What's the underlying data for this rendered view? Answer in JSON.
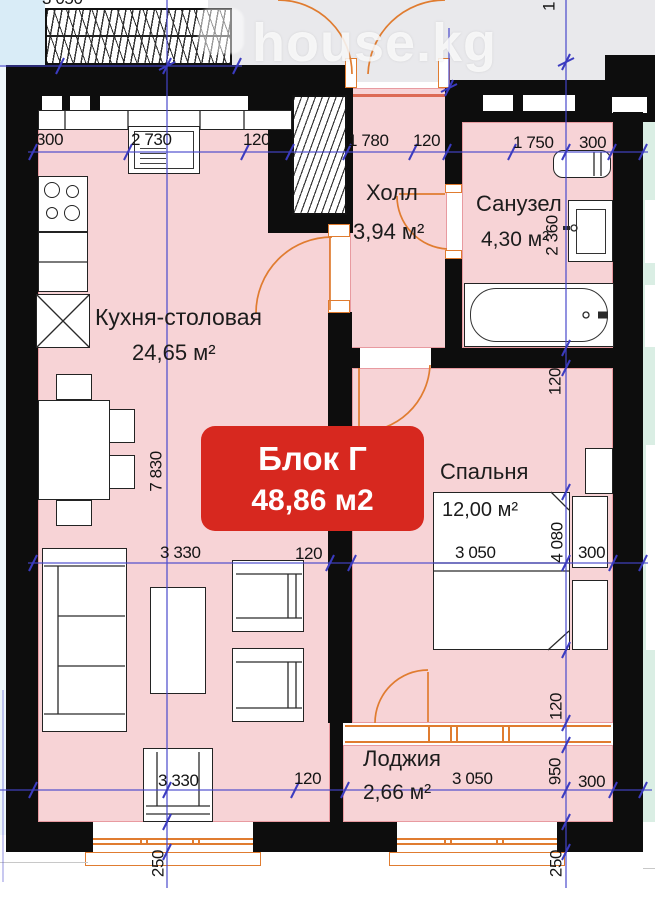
{
  "watermark": {
    "text": "house.kg"
  },
  "badge": {
    "title": "Блок Г",
    "area": "48,86 м2",
    "color": "#d7281f"
  },
  "rooms": {
    "kitchen": {
      "name": "Кухня-столовая",
      "area": "24,65 м²"
    },
    "hall": {
      "name": "Холл",
      "area": "3,94 м²"
    },
    "bathroom": {
      "name": "Санузел",
      "area": "4,30 м²"
    },
    "bedroom": {
      "name": "Спальня",
      "area": "12,00 м²"
    },
    "loggia": {
      "name": "Лоджия",
      "area": "2,66 м²"
    }
  },
  "dimensions": {
    "topleft": {
      "d3050": "3 050"
    },
    "top": {
      "d300a": "300",
      "d2730": "2 730",
      "d120a": "120",
      "d1780": "1 780",
      "d120b": "120",
      "d1750": "1 750",
      "d300b": "300"
    },
    "middle": {
      "d3330": "3 330",
      "d120": "120",
      "d3050": "3 050",
      "d300": "300"
    },
    "bottom": {
      "d3330": "3 330",
      "d120": "120",
      "d3050": "3 050",
      "d300": "300"
    },
    "left": {
      "d7830": "7 830",
      "d250": "250"
    },
    "right": {
      "d1": "1",
      "d2360": "2 360",
      "d120a": "120",
      "d4080": "4 080",
      "d120b": "120",
      "d950": "950",
      "d250": "250"
    }
  },
  "colors": {
    "room_pink": "#f7d3d6",
    "wall_black": "#0d0d0d",
    "door_orange": "#e07c30",
    "dim_blue": "#4545cb",
    "badge_red": "#d7281f",
    "corridor_gray": "#e9e9ec",
    "exterior_blue": "#d9ecf7",
    "neighbor_mint": "#daeee4"
  }
}
